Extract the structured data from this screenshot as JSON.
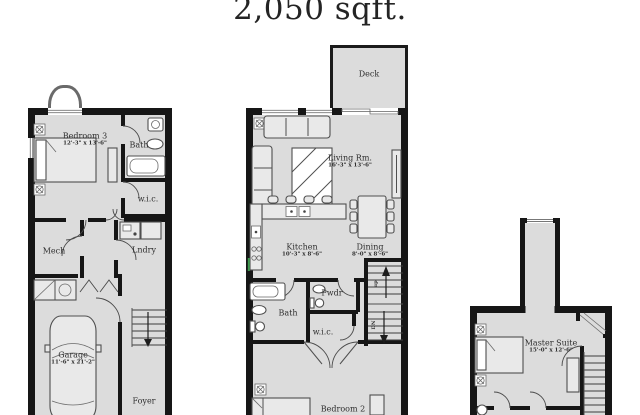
{
  "title": "2,050 sqft.",
  "colors": {
    "wall": "#161616",
    "floor": "#dcdcdc",
    "line": "#4f4f4f",
    "text": "#2e2e2e",
    "accent_green": "#3f9b4f",
    "bg": "#ffffff"
  },
  "plans": {
    "lower": {
      "bedroom3": {
        "name": "Bedroom 3",
        "dims": "12'-3\" x 13'-6\""
      },
      "bath": "Bath",
      "wic": "w.i.c.",
      "mech": "Mech",
      "lndry": "Lndry",
      "garage": {
        "name": "Garage",
        "dims": "11'-6\" x 21'-2\""
      },
      "foyer": "Foyer"
    },
    "main": {
      "deck": "Deck",
      "living": {
        "name": "Living Rm.",
        "dims": "16'-3\" x 13'-6\""
      },
      "kitchen": {
        "name": "Kitchen",
        "dims": "10'-3\" x 8'-6\""
      },
      "dining": {
        "name": "Dining",
        "dims": "8'-0\" x 8'-6\""
      },
      "pwdr": "Pwdr",
      "bath": "Bath",
      "wic": "w.i.c.",
      "bedroom2": "Bedroom 2",
      "stairs_up": "up",
      "stairs_dn": "DN"
    },
    "upper": {
      "master": {
        "name": "Master Suite",
        "dims": "15'-0\" x 12'-6\""
      }
    }
  }
}
